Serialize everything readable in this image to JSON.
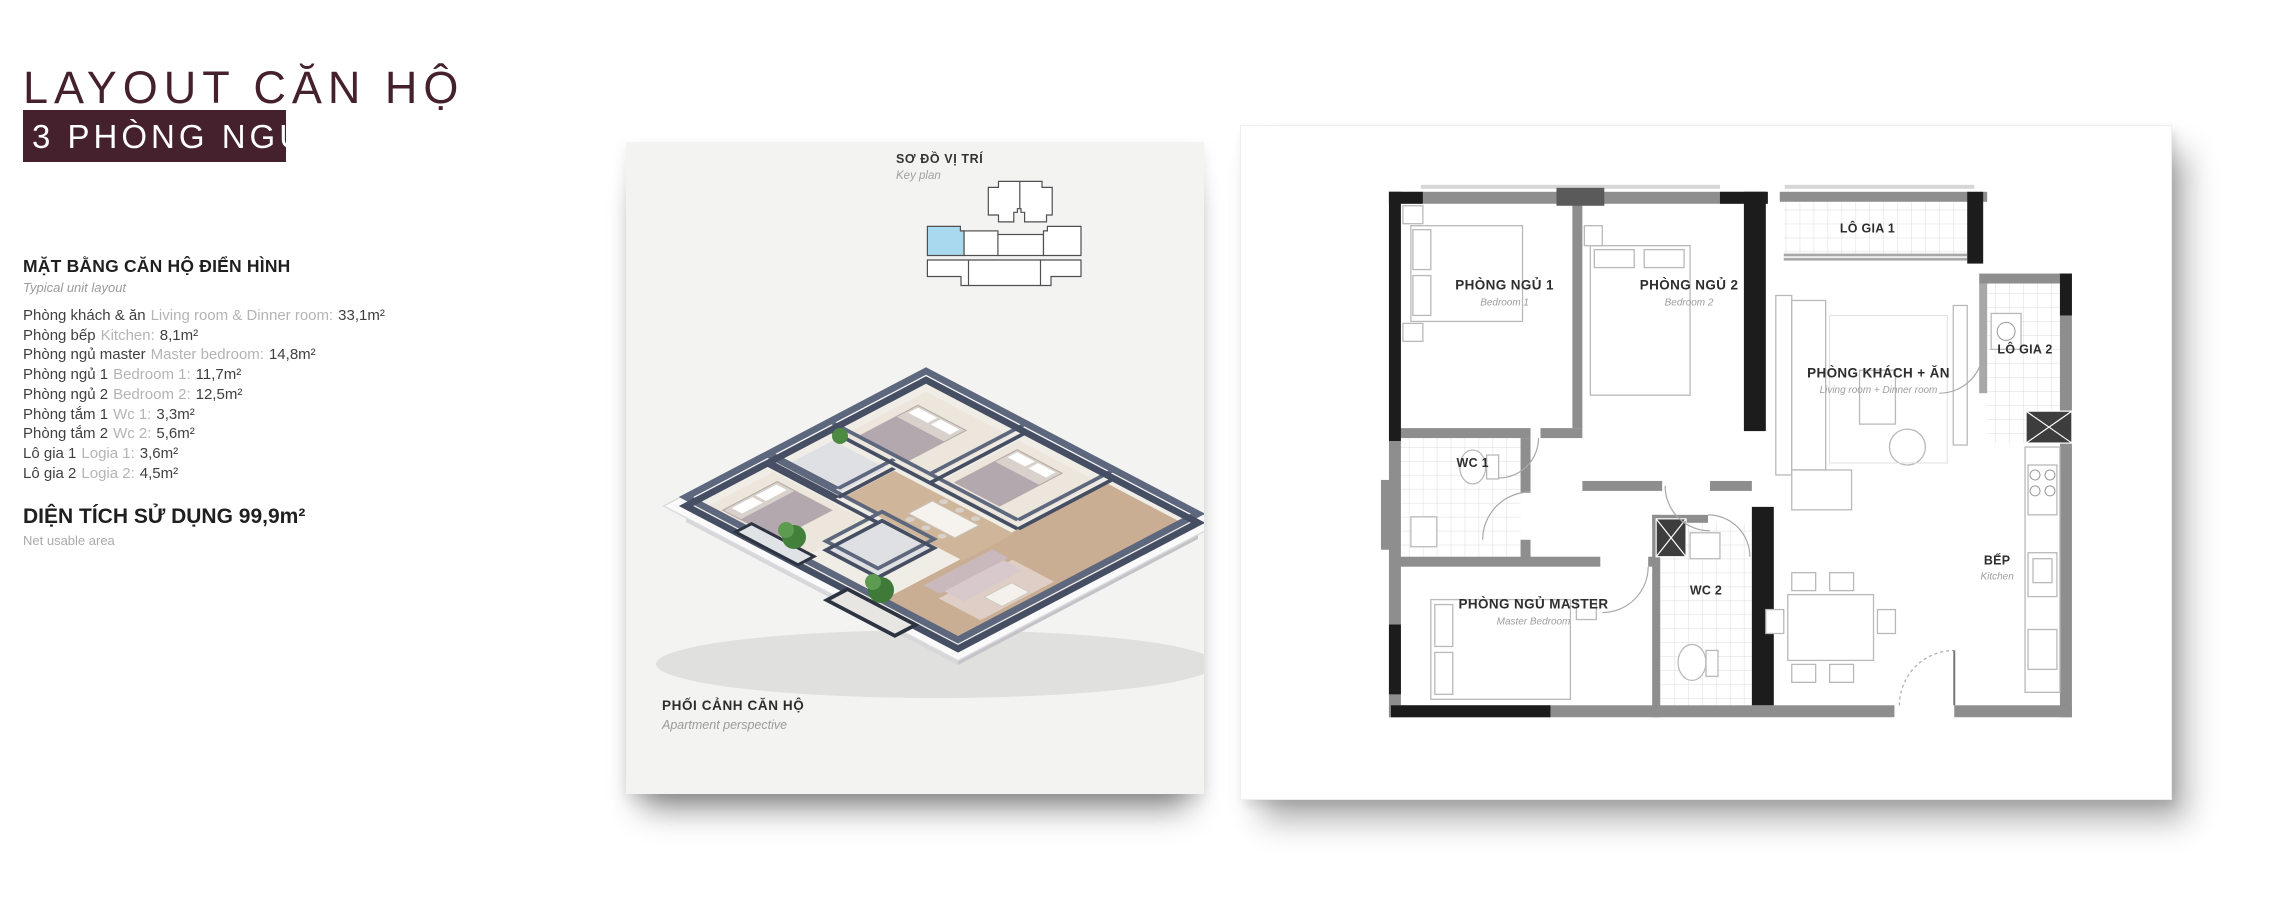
{
  "colors": {
    "maroon": "#45212e",
    "card_bg": "#f3f3f2",
    "keyplan_highlight": "#a9d9ef",
    "wall_dark": "#1c1c1c",
    "wall_gray": "#8e8e8e",
    "iso_wall": "#4b5367",
    "wood_floor": "#c9ae93"
  },
  "left_panel": {
    "title_line1": "LAYOUT CĂN HỘ",
    "title_line2": "3 PHÒNG NGỦ",
    "section_heading": "MẶT BẰNG CĂN HỘ ĐIỂN HÌNH",
    "section_subheading": "Typical  unit layout",
    "rooms": [
      {
        "vi": "Phòng khách & ăn",
        "en": "Living room & Dinner room:",
        "area": "33,1m²"
      },
      {
        "vi": "Phòng bếp",
        "en": "Kitchen:",
        "area": "8,1m²"
      },
      {
        "vi": "Phòng ngủ master",
        "en": "Master bedroom:",
        "area": "14,8m²"
      },
      {
        "vi": "Phòng ngủ 1",
        "en": "Bedroom 1:",
        "area": "11,7m²"
      },
      {
        "vi": "Phòng ngủ 2",
        "en": "Bedroom 2:",
        "area": "12,5m²"
      },
      {
        "vi": "Phòng tắm 1",
        "en": "Wc 1:",
        "area": "3,3m²"
      },
      {
        "vi": "Phòng tắm 2",
        "en": "Wc 2:",
        "area": "5,6m²"
      },
      {
        "vi": "Lô gia 1",
        "en": "Logia 1:",
        "area": "3,6m²"
      },
      {
        "vi": "Lô gia 2",
        "en": "Logia 2:",
        "area": "4,5m²"
      }
    ],
    "total_label": "DIỆN TÍCH SỬ DỤNG",
    "total_value": "99,9m²",
    "total_subtitle": "Net usable area"
  },
  "perspective_card": {
    "keyplan_title": "SƠ ĐỒ VỊ TRÍ",
    "keyplan_subtitle": "Key plan",
    "caption_title": "PHỐI CẢNH CĂN HỘ",
    "caption_subtitle": "Apartment perspective"
  },
  "floorplan": {
    "bedroom1": {
      "name": "PHÒNG NGỦ 1",
      "sub": "Bedroom 1"
    },
    "bedroom2": {
      "name": "PHÒNG NGỦ 2",
      "sub": "Bedroom 2"
    },
    "logia1": {
      "name": "LÔ GIA 1"
    },
    "living": {
      "name": "PHÒNG KHÁCH + ĂN",
      "sub": "Living room + Dinner room"
    },
    "logia2": {
      "name": "LÔ GIA 2"
    },
    "wc1": {
      "name": "WC 1"
    },
    "wc2": {
      "name": "WC 2"
    },
    "master": {
      "name": "PHÒNG NGỦ MASTER",
      "sub": "Master Bedroom"
    },
    "kitchen": {
      "name": "BẾP",
      "sub": "Kitchen"
    }
  }
}
